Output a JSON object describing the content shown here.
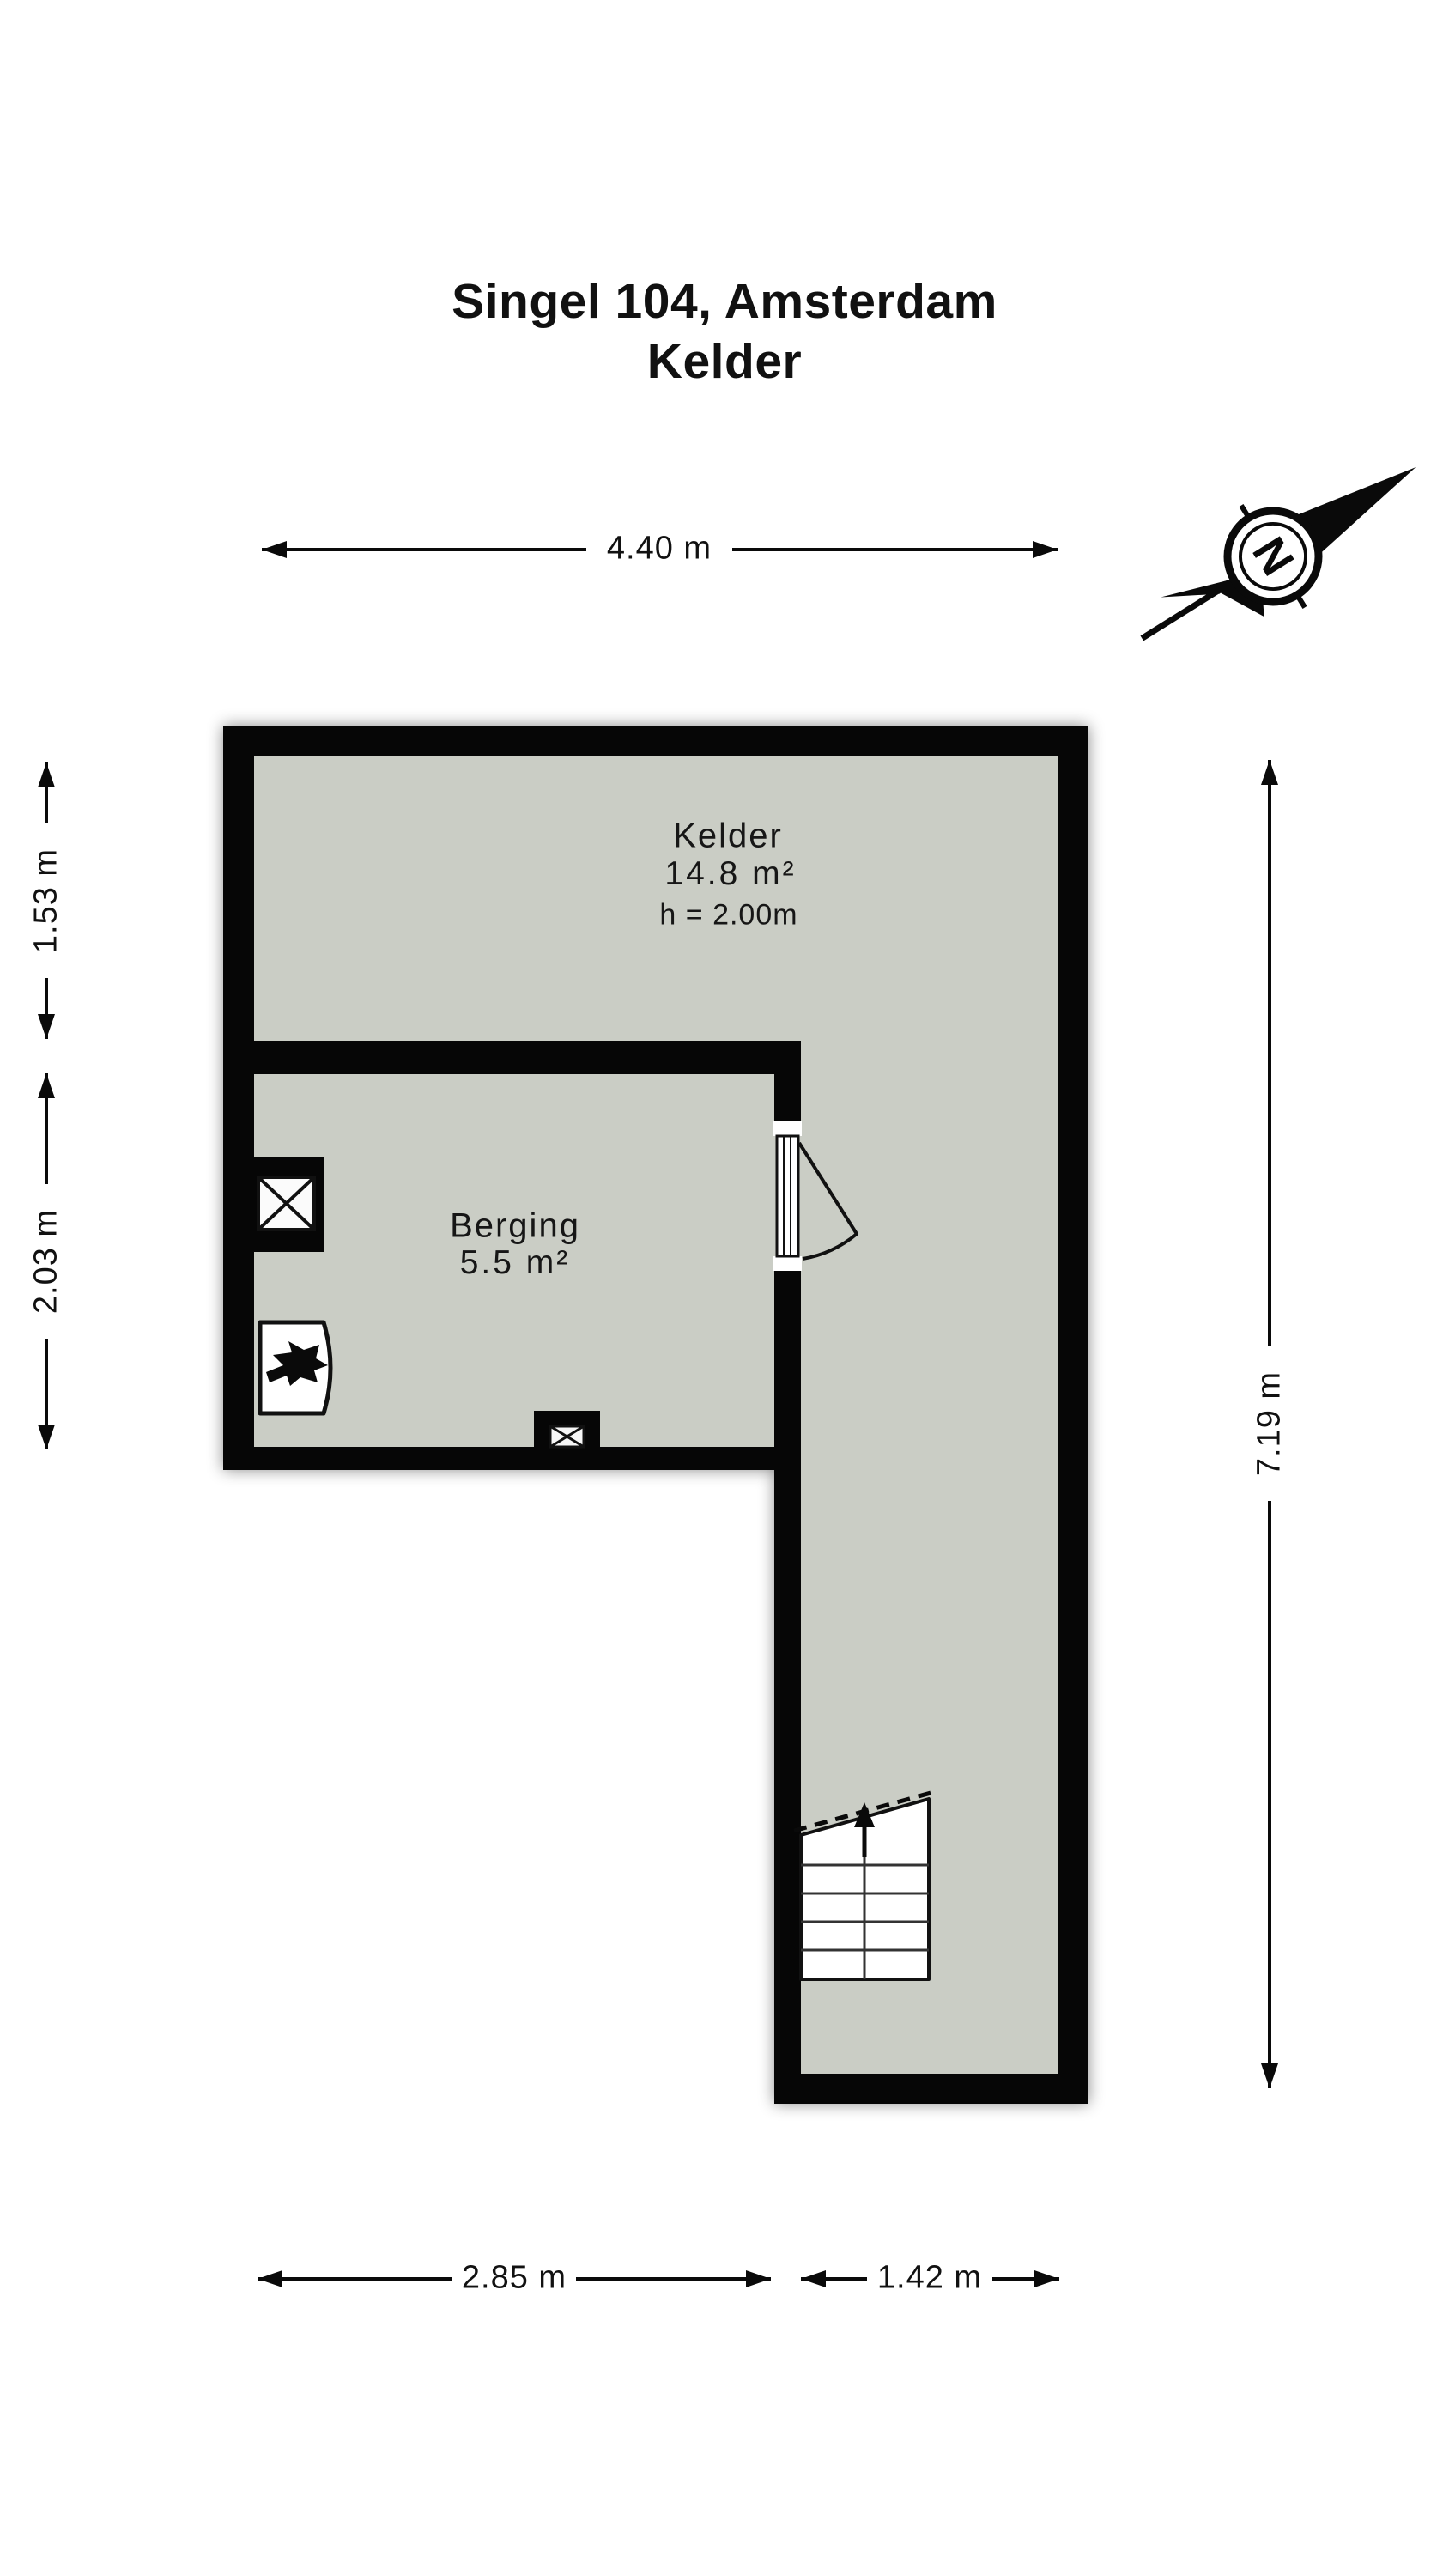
{
  "title": {
    "line1": "Singel 104, Amsterdam",
    "line2": "Kelder"
  },
  "compass": {
    "north_label": "N"
  },
  "rooms": {
    "kelder": {
      "name": "Kelder",
      "area": "14.8 m²",
      "ceiling_height": "h = 2.00m"
    },
    "berging": {
      "name": "Berging",
      "area": "5.5 m²"
    }
  },
  "dimensions": {
    "top_width": "4.40 m",
    "left_upper": "1.53 m",
    "left_lower": "2.03 m",
    "right_height": "7.19 m",
    "bottom_left": "2.85 m",
    "bottom_right": "1.42 m"
  },
  "colors": {
    "floor": "#cacdc5",
    "wall": "#060606",
    "background": "#ffffff"
  }
}
